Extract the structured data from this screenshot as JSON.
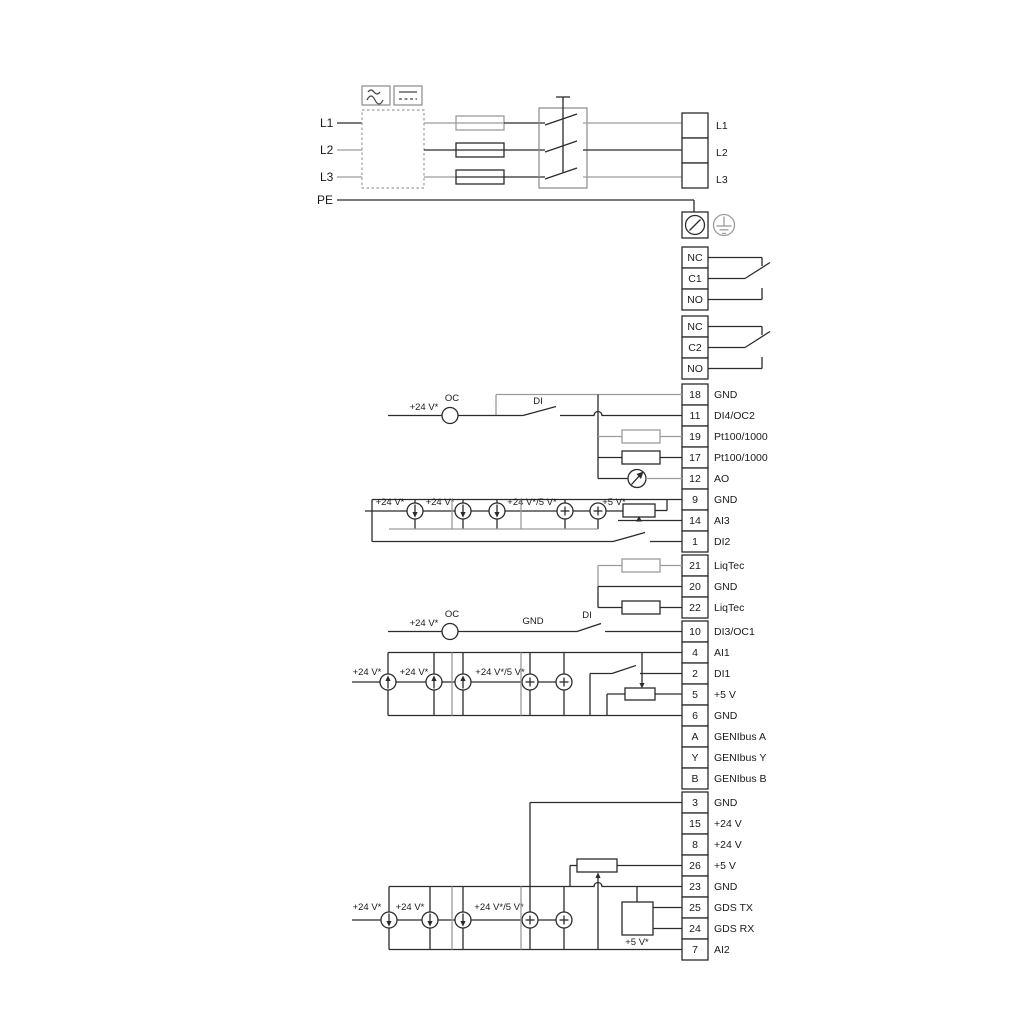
{
  "power": {
    "inputs": [
      "L1",
      "L2",
      "L3",
      "PE"
    ],
    "terminals": [
      "L1",
      "L2",
      "L3"
    ]
  },
  "relay1": [
    "NC",
    "C1",
    "NO"
  ],
  "relay2": [
    "NC",
    "C2",
    "NO"
  ],
  "strip1": [
    {
      "pin": "18",
      "label": "GND"
    },
    {
      "pin": "11",
      "label": "DI4/OC2"
    },
    {
      "pin": "19",
      "label": "Pt100/1000"
    },
    {
      "pin": "17",
      "label": "Pt100/1000"
    },
    {
      "pin": "12",
      "label": "AO"
    },
    {
      "pin": "9",
      "label": "GND"
    },
    {
      "pin": "14",
      "label": "AI3"
    },
    {
      "pin": "1",
      "label": "DI2"
    }
  ],
  "liqtec": [
    {
      "pin": "21",
      "label": "LiqTec"
    },
    {
      "pin": "20",
      "label": "GND"
    },
    {
      "pin": "22",
      "label": "LiqTec"
    }
  ],
  "di3": {
    "pin": "10",
    "label": "DI3/OC1"
  },
  "strip4": [
    {
      "pin": "4",
      "label": "AI1"
    },
    {
      "pin": "2",
      "label": "DI1"
    },
    {
      "pin": "5",
      "label": "+5 V"
    },
    {
      "pin": "6",
      "label": "GND"
    },
    {
      "pin": "A",
      "label": "GENIbus A"
    },
    {
      "pin": "Y",
      "label": "GENIbus Y"
    },
    {
      "pin": "B",
      "label": "GENIbus B"
    }
  ],
  "strip5": [
    {
      "pin": "3",
      "label": "GND"
    },
    {
      "pin": "15",
      "label": "+24 V"
    },
    {
      "pin": "8",
      "label": "+24 V"
    },
    {
      "pin": "26",
      "label": "+5 V"
    },
    {
      "pin": "23",
      "label": "GND"
    },
    {
      "pin": "25",
      "label": "GDS TX"
    },
    {
      "pin": "24",
      "label": "GDS RX"
    },
    {
      "pin": "7",
      "label": "AI2"
    }
  ],
  "ann": {
    "v24": "+24 V*",
    "v245": "+24 V*/5 V*",
    "v5": "+5 V*",
    "oc": "OC",
    "di": "DI",
    "gnd": "GND"
  },
  "colors": {
    "wire": "#2b2b2b",
    "wire_gray": "#9c9c9c"
  }
}
